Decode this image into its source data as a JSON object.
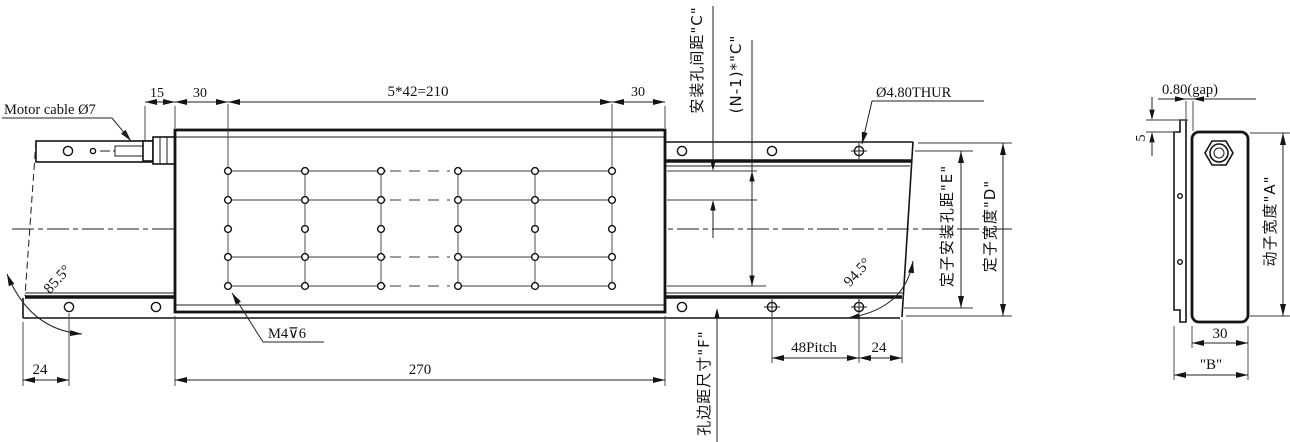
{
  "front_view": {
    "motor_cable_label": "Motor cable Ø7",
    "dim_15": "15",
    "dim_30_left": "30",
    "dim_hole_pitch_top": "5*42=210",
    "dim_30_right": "30",
    "hole_thru_label": "Ø4.80THUR",
    "thread_label": "M4⊽6",
    "angle_left": "85.5°",
    "angle_right": "94.5°",
    "dim_24_left": "24",
    "dim_length_270": "270",
    "dim_48_pitch": "48Pitch",
    "dim_24_right": "24",
    "label_mount_hole_spacing_c": "安装孔间距\"C\"",
    "label_n_minus_1_c": "(N-1)*\"C\"",
    "label_stator_mount_hole_dist_e": "定子安装孔距\"E\"",
    "label_stator_width_d": "定子宽度\"D\"",
    "label_hole_edge_dist_f": "孔边距尺寸\"F\""
  },
  "side_view": {
    "dim_gap": "0.80(gap)",
    "dim_5": "5",
    "label_mover_width_a": "动子宽度\"A\"",
    "dim_30": "30",
    "dim_b": "\"B\""
  },
  "colors": {
    "line": "#141414",
    "background": "#ffffff"
  }
}
